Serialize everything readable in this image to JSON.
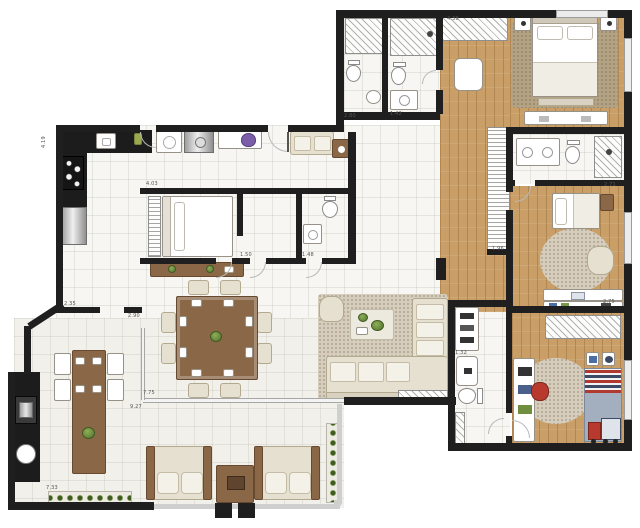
{
  "colors": {
    "wall": "#1f1f1f",
    "wood_floor": "#c99f67",
    "tile_floor": "#f7f6f3",
    "terrace_floor": "#f2f0ea",
    "rug_light": "#d6cdbc",
    "rug_dark": "#b3a283",
    "furniture_wood": "#8a6747",
    "counter_black": "#1c1c1c",
    "upholstery": "#e6e0d1",
    "kids_bed_blue": "#a3aebf",
    "accent_red": "#b83a2e",
    "plant_green": "#51722e",
    "glass_gray": "#c9c9c9",
    "dim_text": "#555555"
  },
  "dimensions": [
    {
      "label": "4.19",
      "x": 42,
      "y": 148,
      "rot": -90
    },
    {
      "label": "4.03",
      "x": 146,
      "y": 182,
      "rot": 0
    },
    {
      "label": "2.80",
      "x": 344,
      "y": 114,
      "rot": 0
    },
    {
      "label": "1.42",
      "x": 390,
      "y": 112,
      "rot": 0
    },
    {
      "label": "4.38",
      "x": 447,
      "y": 17,
      "rot": 0
    },
    {
      "label": "2.71",
      "x": 604,
      "y": 183,
      "rot": 0
    },
    {
      "label": "1.96",
      "x": 492,
      "y": 247,
      "rot": 0
    },
    {
      "label": "2.75",
      "x": 603,
      "y": 300,
      "rot": 0
    },
    {
      "label": "1.32",
      "x": 455,
      "y": 351,
      "rot": 0
    },
    {
      "label": "1.50",
      "x": 240,
      "y": 253,
      "rot": 0
    },
    {
      "label": "1.48",
      "x": 302,
      "y": 253,
      "rot": 0
    },
    {
      "label": "2.35",
      "x": 64,
      "y": 302,
      "rot": 0
    },
    {
      "label": "2.90",
      "x": 128,
      "y": 314,
      "rot": 0
    },
    {
      "label": "7.75",
      "x": 143,
      "y": 391,
      "rot": 0
    },
    {
      "label": "9.27",
      "x": 130,
      "y": 405,
      "rot": 0
    },
    {
      "label": "7.33",
      "x": 46,
      "y": 486,
      "rot": 0
    }
  ]
}
